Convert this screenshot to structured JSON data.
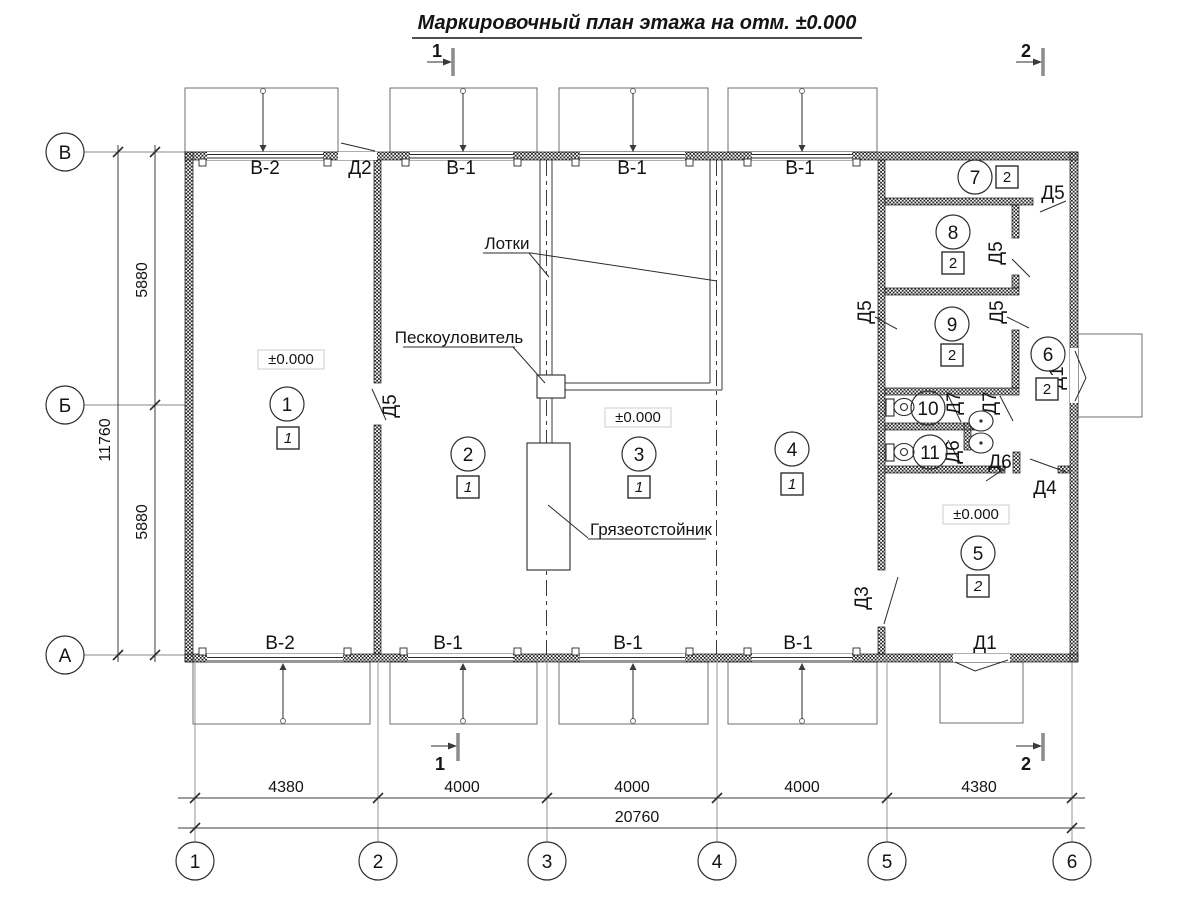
{
  "title": "Маркировочный план этажа на отм. ±0.000",
  "sections": {
    "s1": "1",
    "s2": "2"
  },
  "axes": {
    "left": [
      "В",
      "Б",
      "А"
    ],
    "bottom": [
      "1",
      "2",
      "3",
      "4",
      "5",
      "6"
    ]
  },
  "dims": {
    "left": {
      "segments": [
        "5880",
        "5880"
      ],
      "total": "11760"
    },
    "bottom": {
      "segments": [
        "4380",
        "4000",
        "4000",
        "4000",
        "4380"
      ],
      "total": "20760"
    }
  },
  "labels": {
    "window_v1": "В-1",
    "window_v2": "В-2",
    "elevation": "±0.000"
  },
  "doors": {
    "d1": "Д1",
    "d2": "Д2",
    "d3": "Д3",
    "d4": "Д4",
    "d5": "Д5",
    "d6": "Д6",
    "d7": "Д7"
  },
  "rooms": [
    {
      "num": "1",
      "mark": "1"
    },
    {
      "num": "2",
      "mark": "1"
    },
    {
      "num": "3",
      "mark": "1"
    },
    {
      "num": "4",
      "mark": "1"
    },
    {
      "num": "5",
      "mark": "2"
    },
    {
      "num": "6",
      "mark": "2"
    },
    {
      "num": "7",
      "mark": "2"
    },
    {
      "num": "8",
      "mark": "2"
    },
    {
      "num": "9",
      "mark": "2"
    },
    {
      "num": "10"
    },
    {
      "num": "11"
    }
  ],
  "annotations": {
    "trays": "Лотки",
    "sand_trap": "Пескоуловитель",
    "mud_trap": "Грязеотстойник"
  }
}
